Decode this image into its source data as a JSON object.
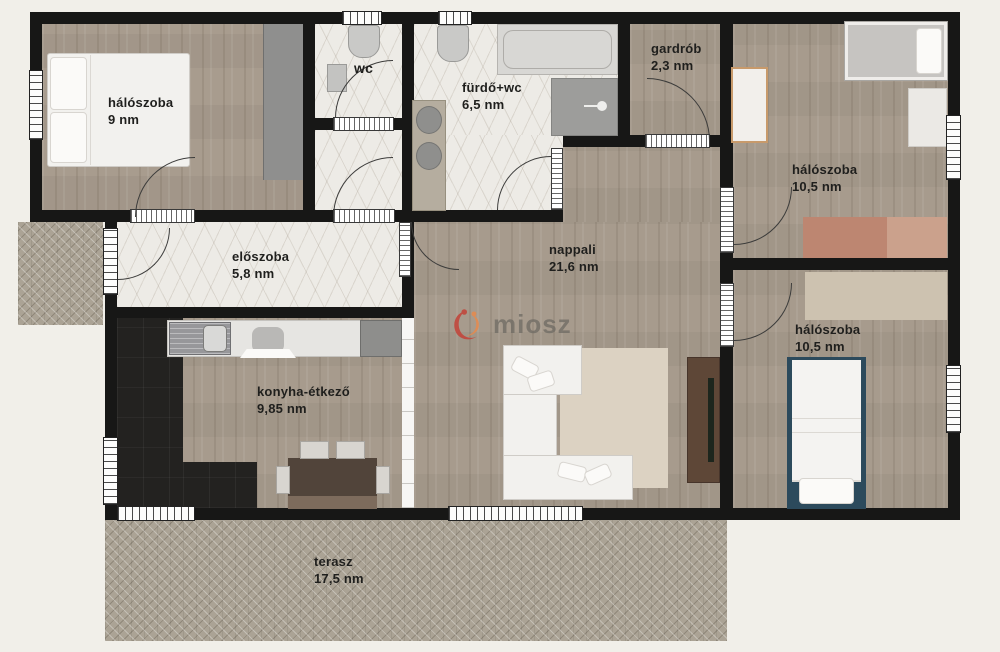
{
  "watermark": {
    "brand": "miosz"
  },
  "rooms": [
    {
      "id": "bedroom-top-left",
      "name": "hálószoba",
      "area": "9 nm"
    },
    {
      "id": "wc",
      "name": "wc",
      "area": ""
    },
    {
      "id": "bathroom",
      "name": "fürdő+wc",
      "area": "6,5 nm"
    },
    {
      "id": "wardrobe-room",
      "name": "gardrób",
      "area": "2,3 nm"
    },
    {
      "id": "bedroom-top-right",
      "name": "hálószoba",
      "area": "10,5 nm"
    },
    {
      "id": "hallway",
      "name": "előszoba",
      "area": "5,8 nm"
    },
    {
      "id": "living-room",
      "name": "nappali",
      "area": "21,6 nm"
    },
    {
      "id": "bedroom-bot-right",
      "name": "hálószoba",
      "area": "10,5 nm"
    },
    {
      "id": "kitchen-dining",
      "name": "konyha-étkező",
      "area": "9,85 nm"
    },
    {
      "id": "terrace",
      "name": "terasz",
      "area": "17,5 nm"
    }
  ],
  "colors": {
    "wall": "#171716",
    "background": "#f1efe9",
    "brand_red": "#c2453a",
    "brand_orange": "#e58a4e",
    "label_text": "#1f1f1d"
  }
}
